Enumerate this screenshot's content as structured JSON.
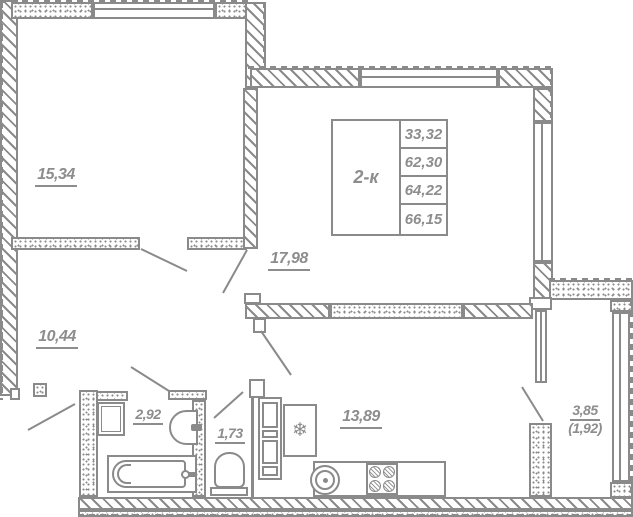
{
  "title": "2-room apartment floor plan",
  "legend": {
    "type_label": "2-к",
    "areas": [
      "33,32",
      "62,30",
      "64,22",
      "66,15"
    ]
  },
  "rooms": {
    "bedroom": {
      "area": "15,34"
    },
    "living": {
      "area": "17,98"
    },
    "hallway": {
      "area": "10,44"
    },
    "bathroom": {
      "area": "2,92"
    },
    "wc": {
      "area": "1,73"
    },
    "kitchen": {
      "area": "13,89"
    },
    "balcony": {
      "area": "3,85",
      "area_reduced": "(1,92)"
    }
  },
  "icons": {
    "fridge_snowflake": "❄"
  },
  "colors": {
    "line": "#8a8a8a",
    "text": "#8d8d8d",
    "background": "#ffffff"
  }
}
